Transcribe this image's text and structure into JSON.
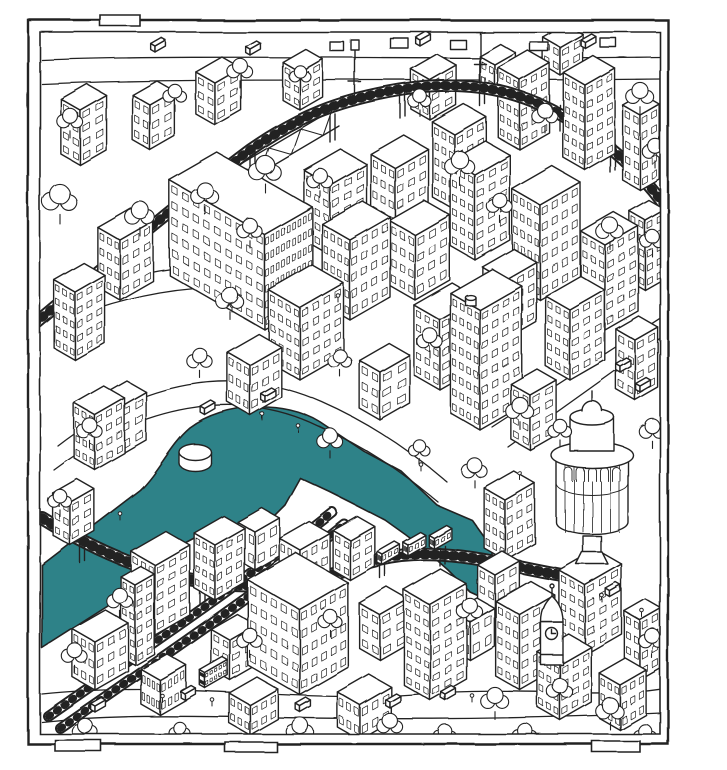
{
  "illustration": {
    "palette": {
      "ink": "#232323",
      "paper": "#ffffff",
      "river": "#2f8288"
    },
    "frame": {
      "outer": [
        28,
        20,
        640,
        724
      ],
      "inner": [
        40,
        32,
        620,
        702
      ],
      "bottom_tabs": [
        [
          55,
          740,
          46,
          11
        ],
        [
          225,
          742,
          52,
          10
        ],
        [
          592,
          741,
          48,
          11
        ]
      ],
      "top_tab": [
        100,
        15,
        40,
        11
      ]
    },
    "river": {
      "path": "M42,565 L140,490 C160,470 170,445 190,428 C225,402 285,400 320,422 L365,452 L402,472 L437,505 L472,520 L492,548 L492,602 L470,592 L448,570 L420,545 L385,520 L350,502 L330,492 L300,478 L285,505 L260,530 L228,542 L198,536 L168,552 L130,592 L42,648 Z",
      "drum": {
        "cx": 195,
        "cy": 452,
        "rx": 16,
        "ry": 8,
        "h": 11
      }
    },
    "roads": [
      "M42,60 C200,54 430,60 662,57",
      "M42,84 C200,77 430,82 662,79",
      "M58,446 C140,382 232,362 322,402 C372,424 412,452 447,482",
      "M54,470 C140,406 236,386 318,426 C368,448 404,474 438,502",
      "M492,427 L662,317",
      "M508,447 L662,337",
      "M42,694 C180,680 300,704 420,694 C520,686 600,699 662,689",
      "M42,722 C180,707 320,728 662,713",
      "M60,300 C150,262 240,255 310,278",
      "M60,322 C150,284 242,277 312,300"
    ],
    "railways": {
      "top_viaduct": {
        "d": "M28,330 C100,270 170,210 250,150 C300,115 340,100 400,90 C480,77 540,95 600,140 C630,163 650,185 666,208",
        "w": 13
      },
      "bottom_track_a": {
        "d": "M48,716 C150,645 240,585 332,512",
        "w": 11
      },
      "bottom_track_b": {
        "d": "M60,728 C162,657 252,597 344,524",
        "w": 11
      },
      "center_arc": {
        "d": "M42,518 C150,585 250,605 360,565 C430,540 500,565 562,575",
        "w": 14
      },
      "viaduct_posts": [
        [
          250,
          152
        ],
        [
          330,
          116
        ],
        [
          400,
          92
        ],
        [
          480,
          80
        ],
        [
          560,
          105
        ],
        [
          610,
          146
        ]
      ],
      "lamp_masts": [
        [
          355,
          100
        ],
        [
          480,
          82
        ],
        [
          608,
          140
        ]
      ],
      "arch_posts": [
        [
          80,
          545
        ],
        [
          140,
          570
        ],
        [
          200,
          588
        ],
        [
          260,
          598
        ],
        [
          320,
          588
        ],
        [
          380,
          560
        ],
        [
          440,
          548
        ],
        [
          500,
          562
        ]
      ],
      "truss": {
        "x1": 205,
        "y1": 185,
        "x2": 332,
        "y2": 110,
        "ox": 7,
        "oy": 16,
        "n": 8
      }
    },
    "train_cars": [
      [
        382,
        565
      ],
      [
        408,
        556
      ],
      [
        434,
        549
      ]
    ],
    "bus": [
      205,
      688
    ],
    "buildings": [
      [
        560,
        75,
        20,
        26,
        28,
        2,
        2
      ],
      [
        495,
        95,
        18,
        24,
        30,
        2,
        2
      ],
      [
        300,
        110,
        20,
        26,
        38,
        2,
        3
      ],
      [
        430,
        120,
        22,
        30,
        40,
        2,
        3
      ],
      [
        215,
        125,
        22,
        30,
        42,
        2,
        3
      ],
      [
        150,
        150,
        20,
        28,
        45,
        2,
        3
      ],
      [
        520,
        150,
        25,
        34,
        70,
        3,
        5
      ],
      [
        80,
        165,
        22,
        30,
        55,
        2,
        4
      ],
      [
        585,
        170,
        25,
        34,
        85,
        3,
        6
      ],
      [
        640,
        190,
        20,
        22,
        75,
        2,
        5
      ],
      [
        455,
        210,
        26,
        36,
        75,
        3,
        5
      ],
      [
        395,
        230,
        28,
        38,
        62,
        3,
        4
      ],
      [
        330,
        255,
        30,
        42,
        70,
        3,
        5
      ],
      [
        475,
        260,
        28,
        40,
        85,
        3,
        6
      ],
      [
        645,
        290,
        18,
        22,
        70,
        2,
        5
      ],
      [
        120,
        300,
        26,
        38,
        60,
        3,
        4
      ],
      [
        540,
        300,
        32,
        46,
        95,
        4,
        6
      ],
      [
        415,
        300,
        30,
        40,
        65,
        3,
        4
      ],
      [
        350,
        320,
        32,
        46,
        80,
        4,
        5
      ],
      [
        265,
        330,
        110,
        55,
        95,
        9,
        6
      ],
      [
        605,
        330,
        28,
        38,
        85,
        3,
        6
      ],
      [
        505,
        340,
        26,
        36,
        60,
        3,
        4
      ],
      [
        75,
        360,
        24,
        34,
        68,
        3,
        5
      ],
      [
        300,
        380,
        36,
        50,
        72,
        4,
        5
      ],
      [
        570,
        380,
        28,
        40,
        70,
        3,
        5
      ],
      [
        635,
        400,
        22,
        26,
        60,
        2,
        4
      ],
      [
        440,
        390,
        30,
        44,
        70,
        3,
        5
      ],
      [
        250,
        415,
        26,
        36,
        50,
        3,
        3
      ],
      [
        380,
        420,
        24,
        34,
        48,
        2,
        3
      ],
      [
        480,
        430,
        34,
        48,
        120,
        4,
        8
      ],
      [
        530,
        450,
        22,
        30,
        55,
        2,
        4
      ],
      [
        120,
        455,
        22,
        30,
        48,
        2,
        3
      ],
      [
        95,
        470,
        24,
        34,
        55,
        3,
        4
      ],
      [
        70,
        545,
        20,
        28,
        42,
        2,
        3
      ],
      [
        505,
        560,
        24,
        34,
        60,
        3,
        4
      ],
      [
        255,
        570,
        20,
        28,
        38,
        2,
        2
      ],
      [
        350,
        580,
        20,
        28,
        40,
        2,
        3
      ],
      [
        215,
        600,
        24,
        34,
        55,
        3,
        4
      ],
      [
        300,
        600,
        24,
        34,
        50,
        3,
        3
      ],
      [
        495,
        620,
        20,
        28,
        45,
        2,
        3
      ],
      [
        155,
        635,
        28,
        40,
        70,
        3,
        5
      ],
      [
        135,
        665,
        16,
        22,
        80,
        2,
        6
      ],
      [
        585,
        655,
        30,
        42,
        70,
        3,
        5
      ],
      [
        380,
        660,
        24,
        32,
        45,
        2,
        3
      ],
      [
        470,
        660,
        20,
        28,
        38,
        2,
        2
      ],
      [
        230,
        680,
        22,
        30,
        40,
        2,
        3
      ],
      [
        640,
        680,
        18,
        24,
        60,
        2,
        4
      ],
      [
        95,
        690,
        26,
        38,
        48,
        3,
        3
      ],
      [
        520,
        690,
        28,
        40,
        75,
        3,
        5
      ],
      [
        300,
        695,
        60,
        55,
        85,
        5,
        5
      ],
      [
        430,
        700,
        30,
        42,
        95,
        3,
        7
      ],
      [
        160,
        715,
        22,
        30,
        35,
        4,
        2
      ],
      [
        560,
        720,
        26,
        36,
        55,
        3,
        4
      ],
      [
        250,
        735,
        24,
        32,
        30,
        3,
        2
      ],
      [
        360,
        740,
        26,
        36,
        35,
        3,
        2
      ],
      [
        620,
        730,
        24,
        30,
        45,
        3,
        3
      ]
    ],
    "round_tower": {
      "cx": 592,
      "top": 455,
      "bottom": 522,
      "rx": 36
    },
    "clock_tower": {
      "cx": 552,
      "base": 665,
      "top": 622,
      "w": 22
    },
    "water_towers": [
      [
        470,
        305
      ],
      [
        250,
        230
      ]
    ],
    "signs": [
      [
        390,
        38,
        18,
        10
      ],
      [
        450,
        40,
        16,
        9
      ],
      [
        530,
        42,
        18,
        9
      ],
      [
        600,
        38,
        16,
        9
      ],
      [
        330,
        42,
        14,
        9
      ]
    ],
    "trees": [
      [
        60,
        200,
        16
      ],
      [
        140,
        215,
        14
      ],
      [
        205,
        195,
        13
      ],
      [
        265,
        170,
        15
      ],
      [
        250,
        230,
        12
      ],
      [
        320,
        180,
        12
      ],
      [
        460,
        165,
        14
      ],
      [
        500,
        205,
        12
      ],
      [
        610,
        230,
        13
      ],
      [
        652,
        240,
        11
      ],
      [
        70,
        120,
        12
      ],
      [
        175,
        95,
        11
      ],
      [
        240,
        70,
        12
      ],
      [
        300,
        75,
        10
      ],
      [
        420,
        100,
        11
      ],
      [
        545,
        115,
        12
      ],
      [
        640,
        95,
        13
      ],
      [
        655,
        150,
        12
      ],
      [
        230,
        300,
        13
      ],
      [
        200,
        360,
        12
      ],
      [
        90,
        430,
        12
      ],
      [
        60,
        500,
        11
      ],
      [
        340,
        360,
        11
      ],
      [
        430,
        340,
        12
      ],
      [
        520,
        410,
        13
      ],
      [
        560,
        430,
        11
      ],
      [
        652,
        430,
        12
      ],
      [
        475,
        470,
        12
      ],
      [
        330,
        440,
        12
      ],
      [
        420,
        450,
        10
      ],
      [
        120,
        600,
        12
      ],
      [
        75,
        655,
        12
      ],
      [
        250,
        640,
        12
      ],
      [
        330,
        620,
        11
      ],
      [
        470,
        610,
        12
      ],
      [
        495,
        700,
        13
      ],
      [
        560,
        690,
        12
      ],
      [
        610,
        710,
        13
      ],
      [
        652,
        640,
        12
      ],
      [
        300,
        730,
        13
      ],
      [
        390,
        725,
        12
      ],
      [
        445,
        735,
        11
      ],
      [
        525,
        735,
        12
      ],
      [
        645,
        735,
        11
      ],
      [
        85,
        730,
        12
      ],
      [
        180,
        732,
        10
      ]
    ],
    "cars": [
      [
        155,
        52
      ],
      [
        250,
        55
      ],
      [
        420,
        46
      ],
      [
        585,
        48
      ],
      [
        205,
        415
      ],
      [
        265,
        402
      ],
      [
        620,
        372
      ],
      [
        640,
        392
      ],
      [
        185,
        700
      ],
      [
        390,
        708
      ],
      [
        300,
        712
      ],
      [
        610,
        597
      ],
      [
        95,
        712
      ],
      [
        445,
        700
      ]
    ],
    "figures": [
      [
        262,
        420
      ],
      [
        298,
        432
      ],
      [
        232,
        312
      ],
      [
        338,
        302
      ],
      [
        422,
        472
      ],
      [
        162,
        702
      ],
      [
        212,
        706
      ],
      [
        472,
        702
      ],
      [
        602,
        602
      ],
      [
        642,
        617
      ],
      [
        120,
        520
      ],
      [
        520,
        480
      ]
    ]
  }
}
